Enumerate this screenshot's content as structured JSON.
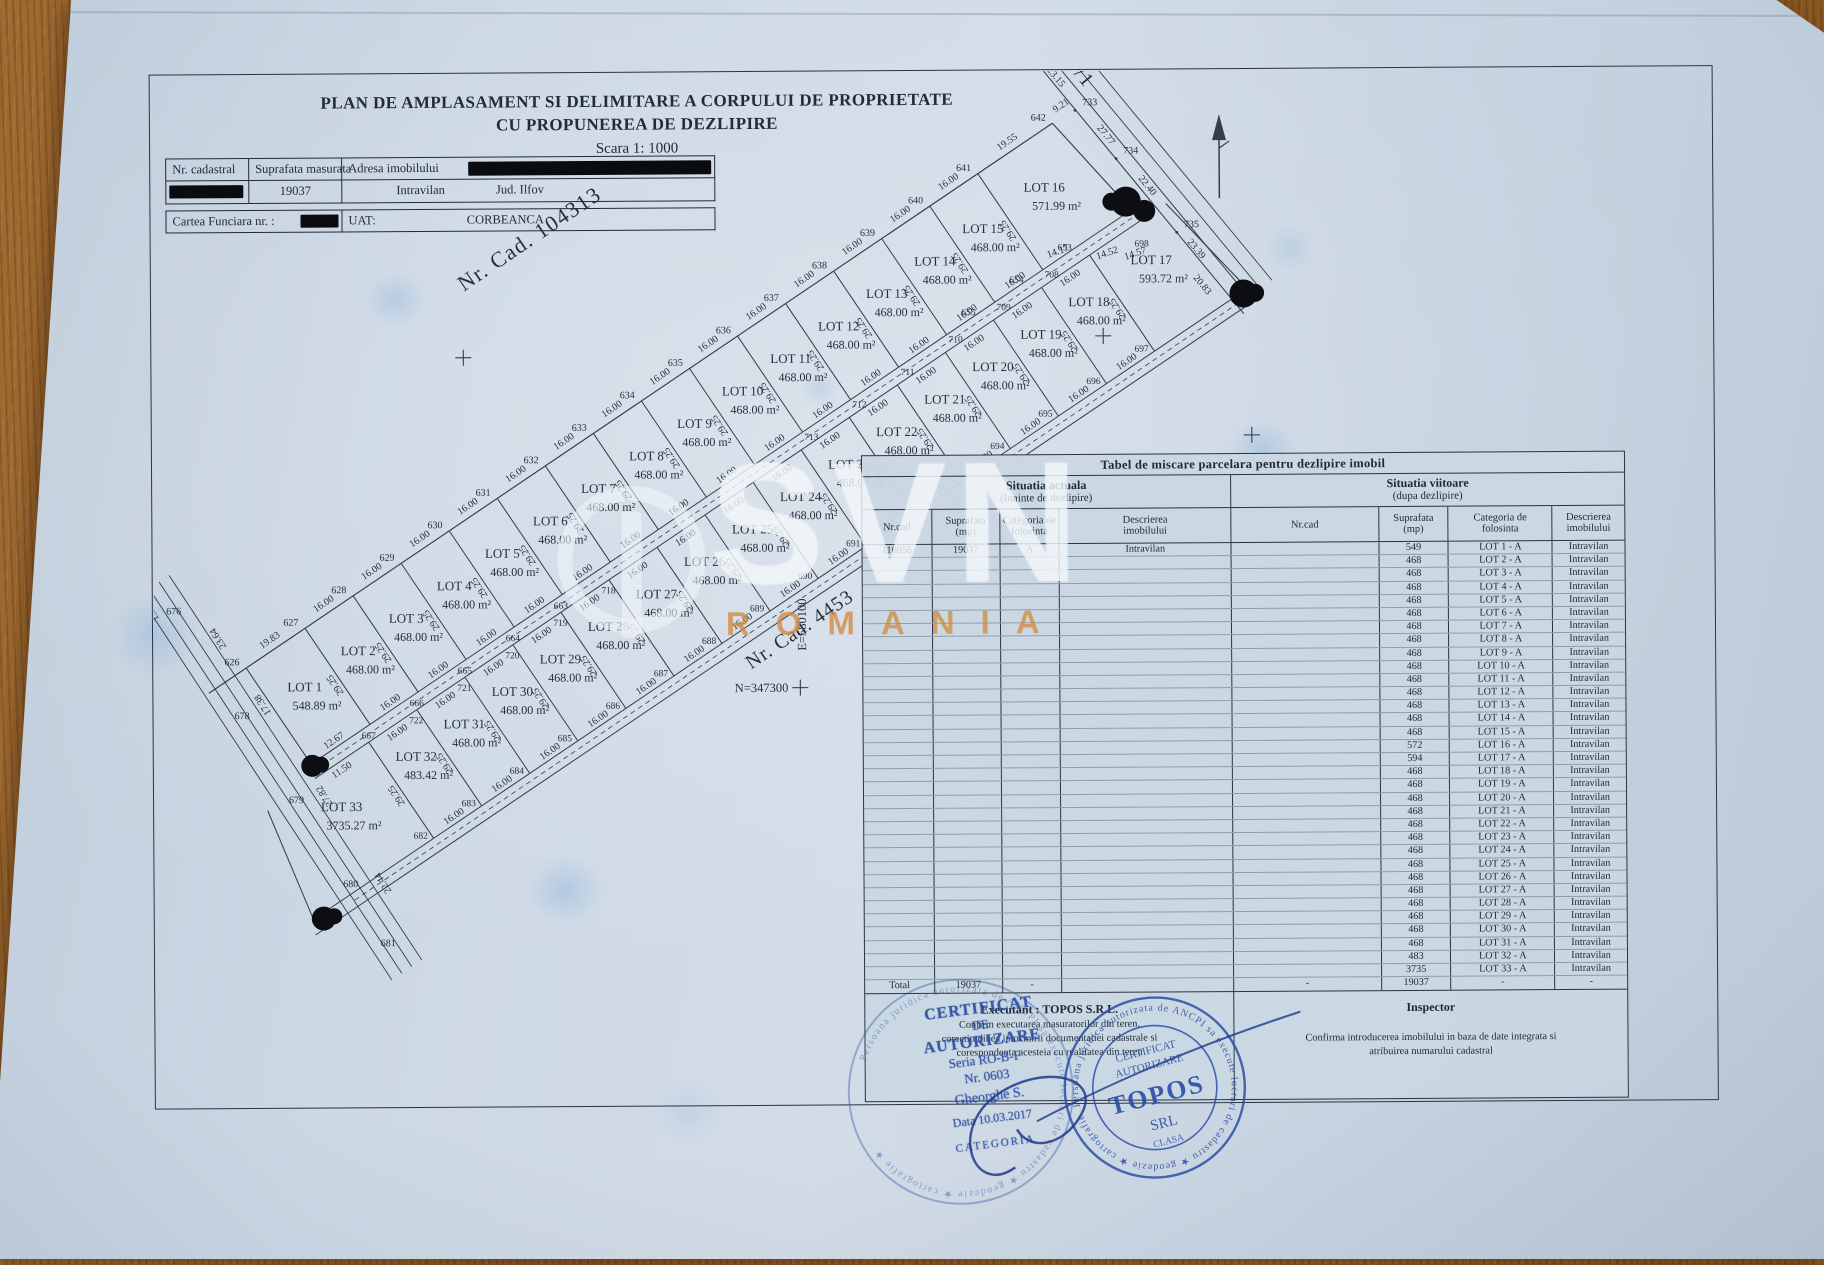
{
  "header": {
    "title1": "PLAN DE AMPLASAMENT SI DELIMITARE A CORPULUI DE PROPRIETATE",
    "title2": "CU PROPUNEREA DE DEZLIPIRE",
    "scale": "Scara 1: 1000",
    "info_table": {
      "c1": "Nr. cadastral",
      "c2": "Suprafata masurata",
      "c3": "Adresa imobilului",
      "v2": "19037",
      "v3a": "Intravilan",
      "v3b": "Jud. Ilfov"
    },
    "cf_table": {
      "c1": "Cartea Funciara nr. :",
      "c2": "UAT:",
      "v2": "CORBEANCA"
    }
  },
  "plan": {
    "cad_upper": "Nr. Cad. 104313",
    "cad_road": "Nr. Cad. 4453",
    "de_road": "DE 10/1",
    "north_label": "N=347300",
    "east_label": "E=580100",
    "dim_front": "16.00",
    "dim_side": "29.25",
    "upper_lots": [
      {
        "name": "LOT 1",
        "area": "548.89 m²"
      },
      {
        "name": "LOT 2",
        "area": "468.00 m²"
      },
      {
        "name": "LOT 3",
        "area": "468.00 m²"
      },
      {
        "name": "LOT 4",
        "area": "468.00 m²"
      },
      {
        "name": "LOT 5",
        "area": "468.00 m²"
      },
      {
        "name": "LOT 6",
        "area": "468.00 m²"
      },
      {
        "name": "LOT 7",
        "area": "468.00 m²"
      },
      {
        "name": "LOT 8",
        "area": "468.00 m²"
      },
      {
        "name": "LOT 9",
        "area": "468.00 m²"
      },
      {
        "name": "LOT 10",
        "area": "468.00 m²"
      },
      {
        "name": "LOT 11",
        "area": "468.00 m²"
      },
      {
        "name": "LOT 12",
        "area": "468.00 m²"
      },
      {
        "name": "LOT 13",
        "area": "468.00 m²"
      },
      {
        "name": "LOT 14",
        "area": "468.00 m²"
      },
      {
        "name": "LOT 15",
        "area": "468.00 m²"
      },
      {
        "name": "LOT 16",
        "area": "571.99 m²"
      }
    ],
    "lower_lots": [
      {
        "name": "LOT 33",
        "area": "3735.27 m²"
      },
      {
        "name": "LOT 32",
        "area": "483.42 m²"
      },
      {
        "name": "LOT 31",
        "area": "468.00 m²"
      },
      {
        "name": "LOT 30",
        "area": "468.00 m²"
      },
      {
        "name": "LOT 29",
        "area": "468.00 m²"
      },
      {
        "name": "LOT 28",
        "area": "468.00 m²"
      },
      {
        "name": "LOT 27",
        "area": "468.00 m²"
      },
      {
        "name": "LOT 26",
        "area": "468.00 m²"
      },
      {
        "name": "LOT 25",
        "area": "468.00 m²"
      },
      {
        "name": "LOT 24",
        "area": "468.00 m²"
      },
      {
        "name": "LOT 23",
        "area": "468.00 m²"
      },
      {
        "name": "LOT 22",
        "area": "468.00 m²"
      },
      {
        "name": "LOT 21",
        "area": "468.00 m²"
      },
      {
        "name": "LOT 20",
        "area": "468.00 m²"
      },
      {
        "name": "LOT 19",
        "area": "468.00 m²"
      },
      {
        "name": "LOT 18",
        "area": "468.00 m²"
      },
      {
        "name": "LOT 17",
        "area": "593.72 m²"
      }
    ],
    "upper_points": [
      "626",
      "627",
      "628",
      "629",
      "630",
      "631",
      "632",
      "633",
      "634",
      "635",
      "636",
      "637",
      "638",
      "639",
      "640",
      "641",
      "642"
    ],
    "mid_road_points": [
      "667",
      "666",
      "665",
      "664",
      "663"
    ],
    "mid_road_points2": [
      "655",
      "654",
      "653"
    ],
    "low_road_points": [
      "722",
      "721",
      "720",
      "719",
      "718"
    ],
    "low_road_points2": [
      "713",
      "712",
      "711",
      "710",
      "709",
      "708"
    ],
    "bottom_points": [
      "682",
      "683",
      "684",
      "685",
      "686",
      "687",
      "688",
      "689",
      "690",
      "691",
      "692",
      "693",
      "694",
      "695",
      "696",
      "697"
    ],
    "left_points": [
      "676",
      "678",
      "679",
      "680",
      "681"
    ],
    "de_points": [
      "733",
      "734",
      "735",
      "736"
    ],
    "extra_point": "698",
    "dims": {
      "lot1_rear": "19.83",
      "lot16_rear": "19.55",
      "gap": "9.21",
      "de": [
        "17.35",
        "23.15",
        "23.15",
        "27.77",
        "22.40",
        "23.39",
        "3.35",
        "20.83"
      ],
      "left": [
        "1.02",
        "23.64",
        "17.38",
        "27.82",
        "22.44"
      ],
      "front1": [
        "12.67",
        "11.50"
      ],
      "lot16_front": [
        "14.17",
        "14.52",
        "14.57"
      ]
    }
  },
  "table": {
    "title": "Tabel de miscare parcelara pentru dezlipire imobil",
    "current_title": "Situatia actuala",
    "current_sub": "(Inainte de dezlipire)",
    "future_title": "Situatia viitoare",
    "future_sub": "(dupa dezlipire)",
    "cols": {
      "nrcad": "Nr.cad",
      "supr": "Suprafata",
      "supr2": "(mp)",
      "cat": "Categoria de",
      "cat2": "folosinta",
      "desc": "Descrierea",
      "desc2": "imobilului"
    },
    "current_row": {
      "nrcad": "110056",
      "supr": "19037",
      "cat": "A",
      "desc": "Intravilan"
    },
    "rows": [
      {
        "supr": "549",
        "lot": "LOT 1 - A",
        "desc": "Intravilan"
      },
      {
        "supr": "468",
        "lot": "LOT 2 - A",
        "desc": "Intravilan"
      },
      {
        "supr": "468",
        "lot": "LOT 3 - A",
        "desc": "Intravilan"
      },
      {
        "supr": "468",
        "lot": "LOT 4 - A",
        "desc": "Intravilan"
      },
      {
        "supr": "468",
        "lot": "LOT 5 - A",
        "desc": "Intravilan"
      },
      {
        "supr": "468",
        "lot": "LOT 6 - A",
        "desc": "Intravilan"
      },
      {
        "supr": "468",
        "lot": "LOT 7 - A",
        "desc": "Intravilan"
      },
      {
        "supr": "468",
        "lot": "LOT 8 - A",
        "desc": "Intravilan"
      },
      {
        "supr": "468",
        "lot": "LOT 9 - A",
        "desc": "Intravilan"
      },
      {
        "supr": "468",
        "lot": "LOT 10 - A",
        "desc": "Intravilan"
      },
      {
        "supr": "468",
        "lot": "LOT 11 - A",
        "desc": "Intravilan"
      },
      {
        "supr": "468",
        "lot": "LOT 12 - A",
        "desc": "Intravilan"
      },
      {
        "supr": "468",
        "lot": "LOT 13 - A",
        "desc": "Intravilan"
      },
      {
        "supr": "468",
        "lot": "LOT 14 - A",
        "desc": "Intravilan"
      },
      {
        "supr": "468",
        "lot": "LOT 15 - A",
        "desc": "Intravilan"
      },
      {
        "supr": "572",
        "lot": "LOT 16 - A",
        "desc": "Intravilan"
      },
      {
        "supr": "594",
        "lot": "LOT 17 - A",
        "desc": "Intravilan"
      },
      {
        "supr": "468",
        "lot": "LOT 18 - A",
        "desc": "Intravilan"
      },
      {
        "supr": "468",
        "lot": "LOT 19 - A",
        "desc": "Intravilan"
      },
      {
        "supr": "468",
        "lot": "LOT 20 - A",
        "desc": "Intravilan"
      },
      {
        "supr": "468",
        "lot": "LOT 21 - A",
        "desc": "Intravilan"
      },
      {
        "supr": "468",
        "lot": "LOT 22 - A",
        "desc": "Intravilan"
      },
      {
        "supr": "468",
        "lot": "LOT 23 - A",
        "desc": "Intravilan"
      },
      {
        "supr": "468",
        "lot": "LOT 24 - A",
        "desc": "Intravilan"
      },
      {
        "supr": "468",
        "lot": "LOT 25 - A",
        "desc": "Intravilan"
      },
      {
        "supr": "468",
        "lot": "LOT 26 - A",
        "desc": "Intravilan"
      },
      {
        "supr": "468",
        "lot": "LOT 27 - A",
        "desc": "Intravilan"
      },
      {
        "supr": "468",
        "lot": "LOT 28 - A",
        "desc": "Intravilan"
      },
      {
        "supr": "468",
        "lot": "LOT 29 - A",
        "desc": "Intravilan"
      },
      {
        "supr": "468",
        "lot": "LOT 30 - A",
        "desc": "Intravilan"
      },
      {
        "supr": "468",
        "lot": "LOT 31 - A",
        "desc": "Intravilan"
      },
      {
        "supr": "483",
        "lot": "LOT 32 - A",
        "desc": "Intravilan"
      },
      {
        "supr": "3735",
        "lot": "LOT 33 - A",
        "desc": "Intravilan"
      }
    ],
    "total": {
      "label": "Total",
      "current_supr": "19037",
      "dash": "-",
      "future_supr": "19037"
    }
  },
  "bottom": {
    "executant_title": "Executant : TOPOS S.R.L.",
    "executant_lines": [
      "Confirm executarea masuratorilor din teren,",
      "corectitudinea intocmirii documentatiei cadastrale si",
      "corespondenta acesteia cu realitatea din teren"
    ],
    "inspector_title": "Inspector",
    "inspector_lines": [
      "Confirma introducerea imobilului in baza de date integrata si",
      "atribuirea numarului cadastral"
    ]
  },
  "stamps": {
    "cert_lines": [
      "CERTIFICAT",
      "DE",
      "AUTORIZARE",
      "Seria RO-B-F",
      "Nr. 0603",
      "Gheorghe S.",
      "Data 10.03.2017",
      "CATEGORIA"
    ],
    "ring_text": "Persoana juridica autorizata de ANCPI sa execute lucrari de cadastru ★ geodezie ★ cartografie ★",
    "round_center": [
      "CERTIFICAT",
      "AUTORIZARE",
      "TOPOS",
      "SRL",
      "CLASA"
    ]
  },
  "watermark": {
    "text": "SVN",
    "sub": "ROMANIA"
  }
}
